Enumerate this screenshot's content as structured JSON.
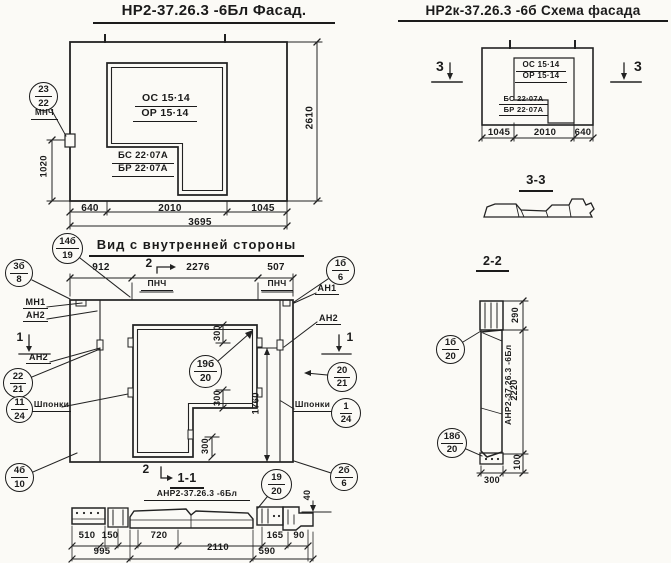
{
  "facade": {
    "title": "НР2-37.26.3 -6Бл Фасад.",
    "window_mark_1": "ОС 15·14",
    "window_mark_2": "ОР 15·14",
    "block_mark_1": "БС 22·07А",
    "block_mark_2": "БР 22·07А",
    "note": "МНЧ",
    "dim_640": "640",
    "dim_2010": "2010",
    "dim_1045": "1045",
    "dim_3695": "3695",
    "dim_2610": "2610",
    "dim_1020": "1020"
  },
  "schema": {
    "title": "НР2к-37.26.3 -6б Схема фасада",
    "window_mark_1": "ОС 15·14",
    "window_mark_2": "ОР 15·14",
    "block_mark_1": "БС 22·07А",
    "block_mark_2": "БР 22·07А",
    "dim_1045": "1045",
    "dim_2010": "2010",
    "dim_640": "640",
    "section_mark": "3",
    "section_3_3_title": "3-3"
  },
  "inner_view": {
    "title": "Вид с внутренней стороны",
    "dim_912": "912",
    "dim_2276": "2276",
    "dim_507": "507",
    "pnch": "ПНЧ",
    "mark_2": "2",
    "mark_1": "1",
    "label_mn1": "МН1",
    "label_an2": "АН2",
    "label_an1": "АН1",
    "label_shponki": "Шпонки",
    "dim_300": "300",
    "dim_1760": "1760"
  },
  "section_1_1": {
    "title": "1-1",
    "label": "АНР2-37.26.3 -6Бл",
    "dim_510": "510",
    "dim_150": "150",
    "dim_720": "720",
    "dim_2110": "2110",
    "dim_165": "165",
    "dim_90": "90",
    "dim_995": "995",
    "dim_590": "590",
    "dim_40": "40"
  },
  "section_2_2": {
    "title": "2-2",
    "label": "АНР2-37.26.3 -6Бл",
    "dim_290": "290",
    "dim_2220": "2220",
    "dim_100": "100",
    "dim_300": "300"
  },
  "balloons": {
    "mnch": {
      "num": "23",
      "den": "22"
    },
    "v14b_19": {
      "num": "14б",
      "den": "19"
    },
    "v3b_8": {
      "num": "3б",
      "den": "8"
    },
    "v22_21": {
      "num": "22",
      "den": "21"
    },
    "v11_24": {
      "num": "11",
      "den": "24"
    },
    "v4b_10": {
      "num": "4б",
      "den": "10"
    },
    "v1b_6": {
      "num": "1б",
      "den": "6"
    },
    "v20_21": {
      "num": "20",
      "den": "21"
    },
    "v1_24": {
      "num": "1",
      "den": "24"
    },
    "v2b_6": {
      "num": "2б",
      "den": "6"
    },
    "v19_20": {
      "num": "19",
      "den": "20"
    },
    "v19b_20": {
      "num": "19б",
      "den": "20"
    },
    "v1b_20": {
      "num": "1б",
      "den": "20"
    },
    "v18b_20": {
      "num": "18б",
      "den": "20"
    }
  }
}
